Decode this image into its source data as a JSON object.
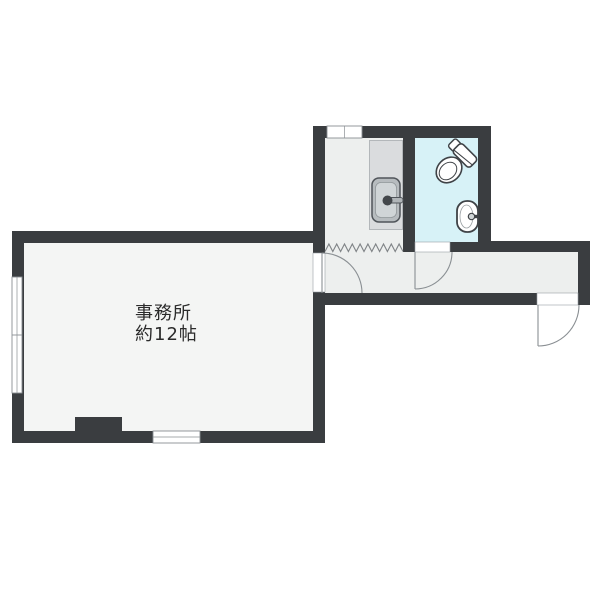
{
  "floorplan": {
    "office": {
      "label": "事務所",
      "area": "約12帖"
    },
    "rooms": [
      {
        "name": "office",
        "label": "事務所 約12帖"
      },
      {
        "name": "kitchenette-hall",
        "label": ""
      },
      {
        "name": "toilet-room",
        "label": ""
      }
    ],
    "fixtures": [
      "kitchen-sink",
      "toilet",
      "hand-basin"
    ],
    "symbols": [
      "door-swing-arc",
      "accordion-curtain",
      "sliding-window"
    ],
    "colors": {
      "wall": "#3a3d40",
      "office_floor": "#f4f5f4",
      "hall_floor": "#edefee",
      "toilet_floor": "#d7f2f7",
      "counter_fill": "#dadcde",
      "outline": "#3f4347",
      "background": "#ffffff",
      "label_color": "#2b2b2b"
    }
  }
}
